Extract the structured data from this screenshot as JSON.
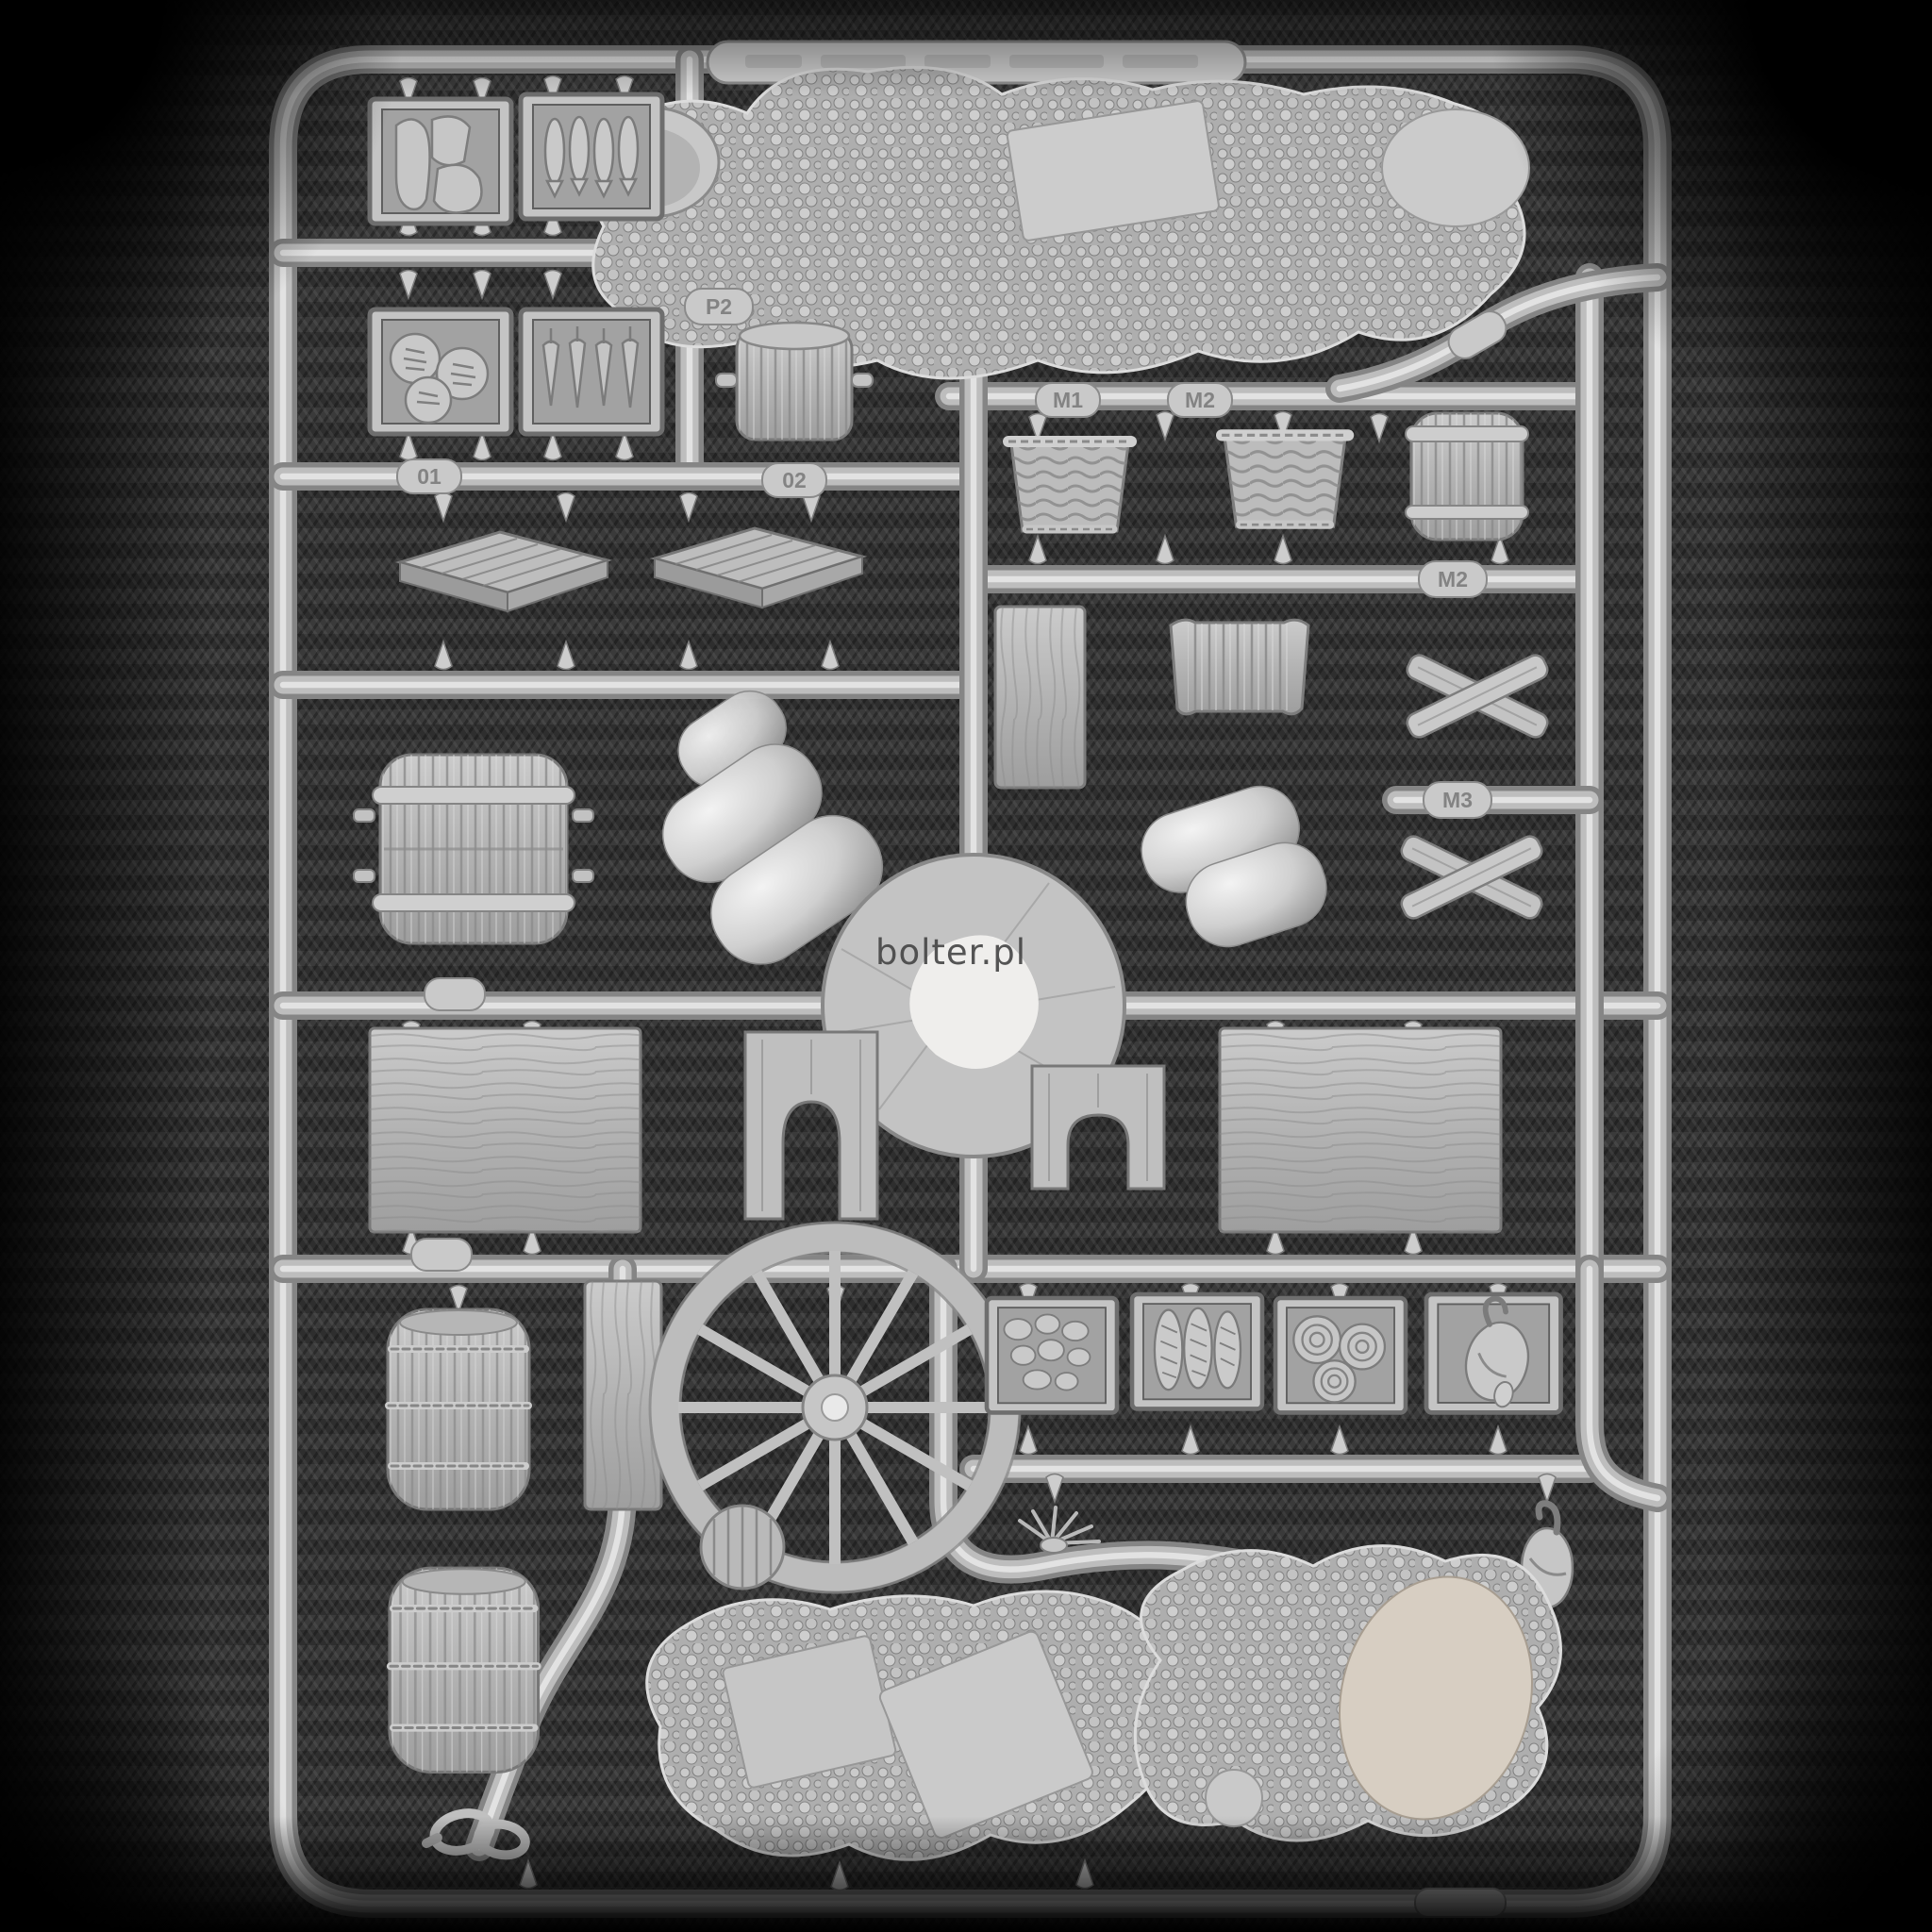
{
  "photo": {
    "watermark": "bolter.pl",
    "subject": "grey plastic model sprue of market / wagon accessories photographed on dark herringbone fabric",
    "background_fabric_color": "#343434",
    "plastic_color": "#bdbdbd",
    "beige_patch_color": "#d7cec2"
  },
  "sprue": {
    "labels": [
      {
        "text": "01"
      },
      {
        "text": "02"
      },
      {
        "text": "P2"
      },
      {
        "text": "M1"
      },
      {
        "text": "M2"
      },
      {
        "text": "M2"
      },
      {
        "text": "M3"
      }
    ],
    "parts": [
      "meat-tray",
      "fish-tray",
      "bread-tray",
      "carrot-tray",
      "large-textured-base",
      "cloth-roller",
      "wicker-basket-1",
      "wicker-basket-2",
      "slatted-cask",
      "duckboard-1",
      "duckboard-2",
      "ribbed-barrel-lying",
      "plank-middle",
      "wrapped-bale",
      "crossed-sticks-1",
      "crossed-sticks-2",
      "sack-pile-1",
      "sack-pile-2",
      "sprue-hub",
      "table-top-left",
      "trestle-arch-1",
      "trestle-arch-2",
      "table-top-right",
      "standing-barrel-1",
      "plank-lower",
      "cart-wheel",
      "potato-tray",
      "baguette-tray",
      "rope-coil-tray",
      "poultry-tray",
      "herb-bundle",
      "rope-coil-disc",
      "hanging-goose",
      "standing-barrel-2",
      "rope-loop",
      "textured-base-a",
      "textured-base-b"
    ]
  }
}
